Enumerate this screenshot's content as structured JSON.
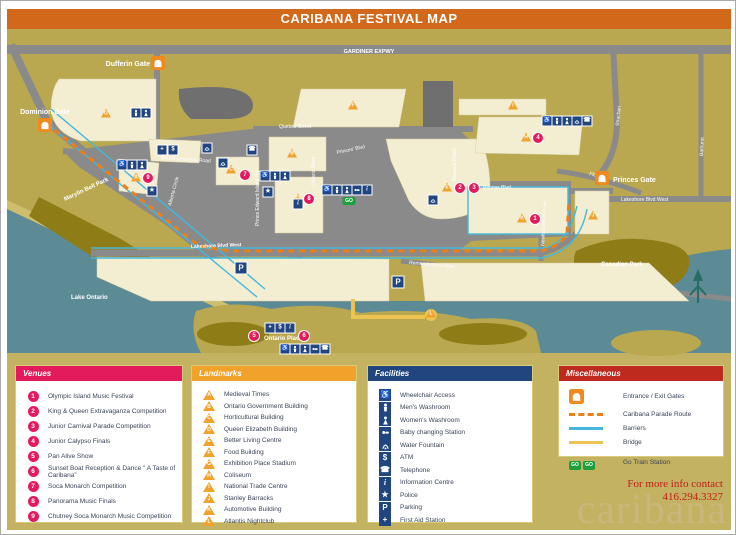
{
  "title": "CARIBANA FESTIVAL MAP",
  "colors": {
    "title_bar": "#d2691a",
    "land": "#b9a84f",
    "legend_bg": "#c3b261",
    "water": "#5c8b96",
    "park": "#8e7c17",
    "road": "#8a8a8a",
    "building": "#f3edd1",
    "venue": "#e31b5d",
    "landmark": "#f0a22b",
    "facility": "#20457f",
    "misc": "#be2a1d",
    "parade": "#ee7e17",
    "barrier": "#45b8dc",
    "bridge": "#ecc452",
    "go": "#1f9e3c",
    "logo": "#c9b77b"
  },
  "map": {
    "roads": {
      "gardiner": "GARDINER EXPWY",
      "british_columbia": "British Columbia Road",
      "quebec": "Quebec Street",
      "ontario_drive": "Ontario Drive",
      "princes_blvd_w": "Princes' Blvd",
      "princes_blvd_e": "Princes Blvd",
      "nunavut": "Nunavut Road",
      "pei": "Prince Edward Island Rd",
      "alberta": "Alberta Circle",
      "newfoundland": "Newfoundland Drive",
      "strachan": "Strachan",
      "bathurst": "Bathurst",
      "fleet": "Fleet St.",
      "lakeshore_center": "Lakeshore Blvd West",
      "lakeshore_east": "Lakeshore Blvd West",
      "remembrance": "Remembrance Drive"
    },
    "areas": {
      "marilyn_bell_park": "Marylin Bell Park",
      "lake_ontario": "Lake Ontario",
      "ontario_place": "Ontario Place",
      "canadian_park": "Canadian Park"
    },
    "gates": [
      {
        "label": "Dufferin Gate",
        "x": 157,
        "y": 62
      },
      {
        "label": "Dominion Gate",
        "x": 44,
        "y": 124
      },
      {
        "label": "Princes Gate",
        "x": 601,
        "y": 177
      }
    ],
    "markers": {
      "venues": [
        {
          "n": "9",
          "x": 147,
          "y": 177
        },
        {
          "n": "7",
          "x": 244,
          "y": 174
        },
        {
          "n": "8",
          "x": 308,
          "y": 198
        },
        {
          "n": "2",
          "x": 459,
          "y": 187
        },
        {
          "n": "3",
          "x": 473,
          "y": 187
        },
        {
          "n": "4",
          "x": 537,
          "y": 137
        },
        {
          "n": "1",
          "x": 534,
          "y": 218
        },
        {
          "n": "5",
          "x": 253,
          "y": 335
        },
        {
          "n": "6",
          "x": 303,
          "y": 335
        }
      ],
      "landmarks": [
        {
          "l": "G",
          "x": 105,
          "y": 112
        },
        {
          "l": "F",
          "x": 352,
          "y": 104
        },
        {
          "l": "B",
          "x": 291,
          "y": 152
        },
        {
          "l": "C",
          "x": 230,
          "y": 168
        },
        {
          "l": "A",
          "x": 135,
          "y": 176
        },
        {
          "l": "D",
          "x": 297,
          "y": 197
        },
        {
          "l": "E",
          "x": 446,
          "y": 186
        },
        {
          "l": "H",
          "x": 525,
          "y": 136
        },
        {
          "l": "I",
          "x": 512,
          "y": 104
        },
        {
          "l": "J",
          "x": 592,
          "y": 214
        },
        {
          "l": "K",
          "x": 521,
          "y": 217
        },
        {
          "l": "L",
          "x": 430,
          "y": 312
        }
      ],
      "facilities": [
        {
          "icon": "men",
          "x": 135,
          "y": 112
        },
        {
          "icon": "women",
          "x": 145,
          "y": 112
        },
        {
          "icon": "firstaid",
          "x": 161,
          "y": 149
        },
        {
          "icon": "atm",
          "x": 172,
          "y": 149
        },
        {
          "icon": "wheelchair",
          "x": 121,
          "y": 164
        },
        {
          "icon": "men",
          "x": 131,
          "y": 164
        },
        {
          "icon": "women",
          "x": 141,
          "y": 164
        },
        {
          "icon": "police",
          "x": 151,
          "y": 190
        },
        {
          "icon": "fountain",
          "x": 206,
          "y": 147
        },
        {
          "icon": "fountain",
          "x": 222,
          "y": 162
        },
        {
          "icon": "phone",
          "x": 251,
          "y": 149
        },
        {
          "icon": "wheelchair",
          "x": 264,
          "y": 175
        },
        {
          "icon": "men",
          "x": 274,
          "y": 175
        },
        {
          "icon": "women",
          "x": 284,
          "y": 175
        },
        {
          "icon": "police",
          "x": 267,
          "y": 191
        },
        {
          "icon": "info",
          "x": 297,
          "y": 203
        },
        {
          "icon": "wheelchair",
          "x": 326,
          "y": 189
        },
        {
          "icon": "men",
          "x": 336,
          "y": 189
        },
        {
          "icon": "women",
          "x": 346,
          "y": 189
        },
        {
          "icon": "baby",
          "x": 356,
          "y": 189
        },
        {
          "icon": "info",
          "x": 366,
          "y": 189
        },
        {
          "icon": "go",
          "x": 348,
          "y": 200
        },
        {
          "icon": "fountain",
          "x": 432,
          "y": 199
        },
        {
          "icon": "wheelchair",
          "x": 546,
          "y": 120
        },
        {
          "icon": "men",
          "x": 556,
          "y": 120
        },
        {
          "icon": "women",
          "x": 566,
          "y": 120
        },
        {
          "icon": "fountain",
          "x": 576,
          "y": 120
        },
        {
          "icon": "phone",
          "x": 586,
          "y": 120
        },
        {
          "icon": "parking",
          "x": 240,
          "y": 267
        },
        {
          "icon": "parking",
          "x": 397,
          "y": 281
        },
        {
          "icon": "firstaid",
          "x": 269,
          "y": 327
        },
        {
          "icon": "atm",
          "x": 279,
          "y": 327
        },
        {
          "icon": "info",
          "x": 289,
          "y": 327
        },
        {
          "icon": "wheelchair",
          "x": 284,
          "y": 348
        },
        {
          "icon": "men",
          "x": 294,
          "y": 348
        },
        {
          "icon": "women",
          "x": 304,
          "y": 348
        },
        {
          "icon": "baby",
          "x": 314,
          "y": 348
        },
        {
          "icon": "phone",
          "x": 324,
          "y": 348
        }
      ]
    }
  },
  "legend": {
    "venues": {
      "title": "Venues",
      "items": [
        {
          "num": "1",
          "label": "Olympic Island Music Festival"
        },
        {
          "num": "2",
          "label": "King & Queen Extravaganza Competition"
        },
        {
          "num": "3",
          "label": "Junior Carnival Parade Competition"
        },
        {
          "num": "4",
          "label": "Junior Calypso Finals"
        },
        {
          "num": "5",
          "label": "Pan Alive Show"
        },
        {
          "num": "6",
          "label": "Sunset Boat Reception & Dance \" A Taste of Caribana\""
        },
        {
          "num": "7",
          "label": "Soca Monarch Competition"
        },
        {
          "num": "8",
          "label": "Panorama Music Finals"
        },
        {
          "num": "9",
          "label": "Chutney Soca Monarch Music Competition"
        }
      ]
    },
    "landmarks": {
      "title": "Landmarks",
      "items": [
        {
          "letter": "A",
          "label": "Medieval Times"
        },
        {
          "letter": "B",
          "label": "Ontario Government Building"
        },
        {
          "letter": "C",
          "label": "Horticultural Building"
        },
        {
          "letter": "D",
          "label": "Queen Elizabeth Building"
        },
        {
          "letter": "E",
          "label": "Better Living Centre"
        },
        {
          "letter": "F",
          "label": "Food Building"
        },
        {
          "letter": "G",
          "label": "Exhibition Place Stadium"
        },
        {
          "letter": "H",
          "label": "Coliseum"
        },
        {
          "letter": "I",
          "label": "National Trade Centre"
        },
        {
          "letter": "J",
          "label": "Stanley Barracks"
        },
        {
          "letter": "K",
          "label": "Automotive Building"
        },
        {
          "letter": "L",
          "label": "Atlantis Nightclub"
        }
      ]
    },
    "facilities": {
      "title": "Facilities",
      "items": [
        {
          "icon": "wheelchair",
          "label": "Wheelchair Access"
        },
        {
          "icon": "men",
          "label": "Men's Washroom"
        },
        {
          "icon": "women",
          "label": "Women's Washroom"
        },
        {
          "icon": "baby",
          "label": "Baby changing Station"
        },
        {
          "icon": "fountain",
          "label": "Water Fountain"
        },
        {
          "icon": "atm",
          "label": "ATM"
        },
        {
          "icon": "phone",
          "label": "Telephone"
        },
        {
          "icon": "info",
          "label": "Information Centre"
        },
        {
          "icon": "police",
          "label": "Police"
        },
        {
          "icon": "parking",
          "label": "Parking"
        },
        {
          "icon": "firstaid",
          "label": "First Aid Station"
        }
      ]
    },
    "misc": {
      "title": "Miscellaneous",
      "items": [
        {
          "icon": "gate",
          "label": "Entrance / Exit Gates"
        },
        {
          "icon": "route",
          "label": "Caribana Parade Route"
        },
        {
          "icon": "barrier",
          "label": "Barriers"
        },
        {
          "icon": "bridge",
          "label": "Bridge"
        },
        {
          "icon": "go",
          "label": "Go Train Station"
        }
      ]
    }
  },
  "footer": {
    "contact_line1": "For more info contact",
    "contact_line2": "416.294.3327",
    "logo": "caribana"
  }
}
